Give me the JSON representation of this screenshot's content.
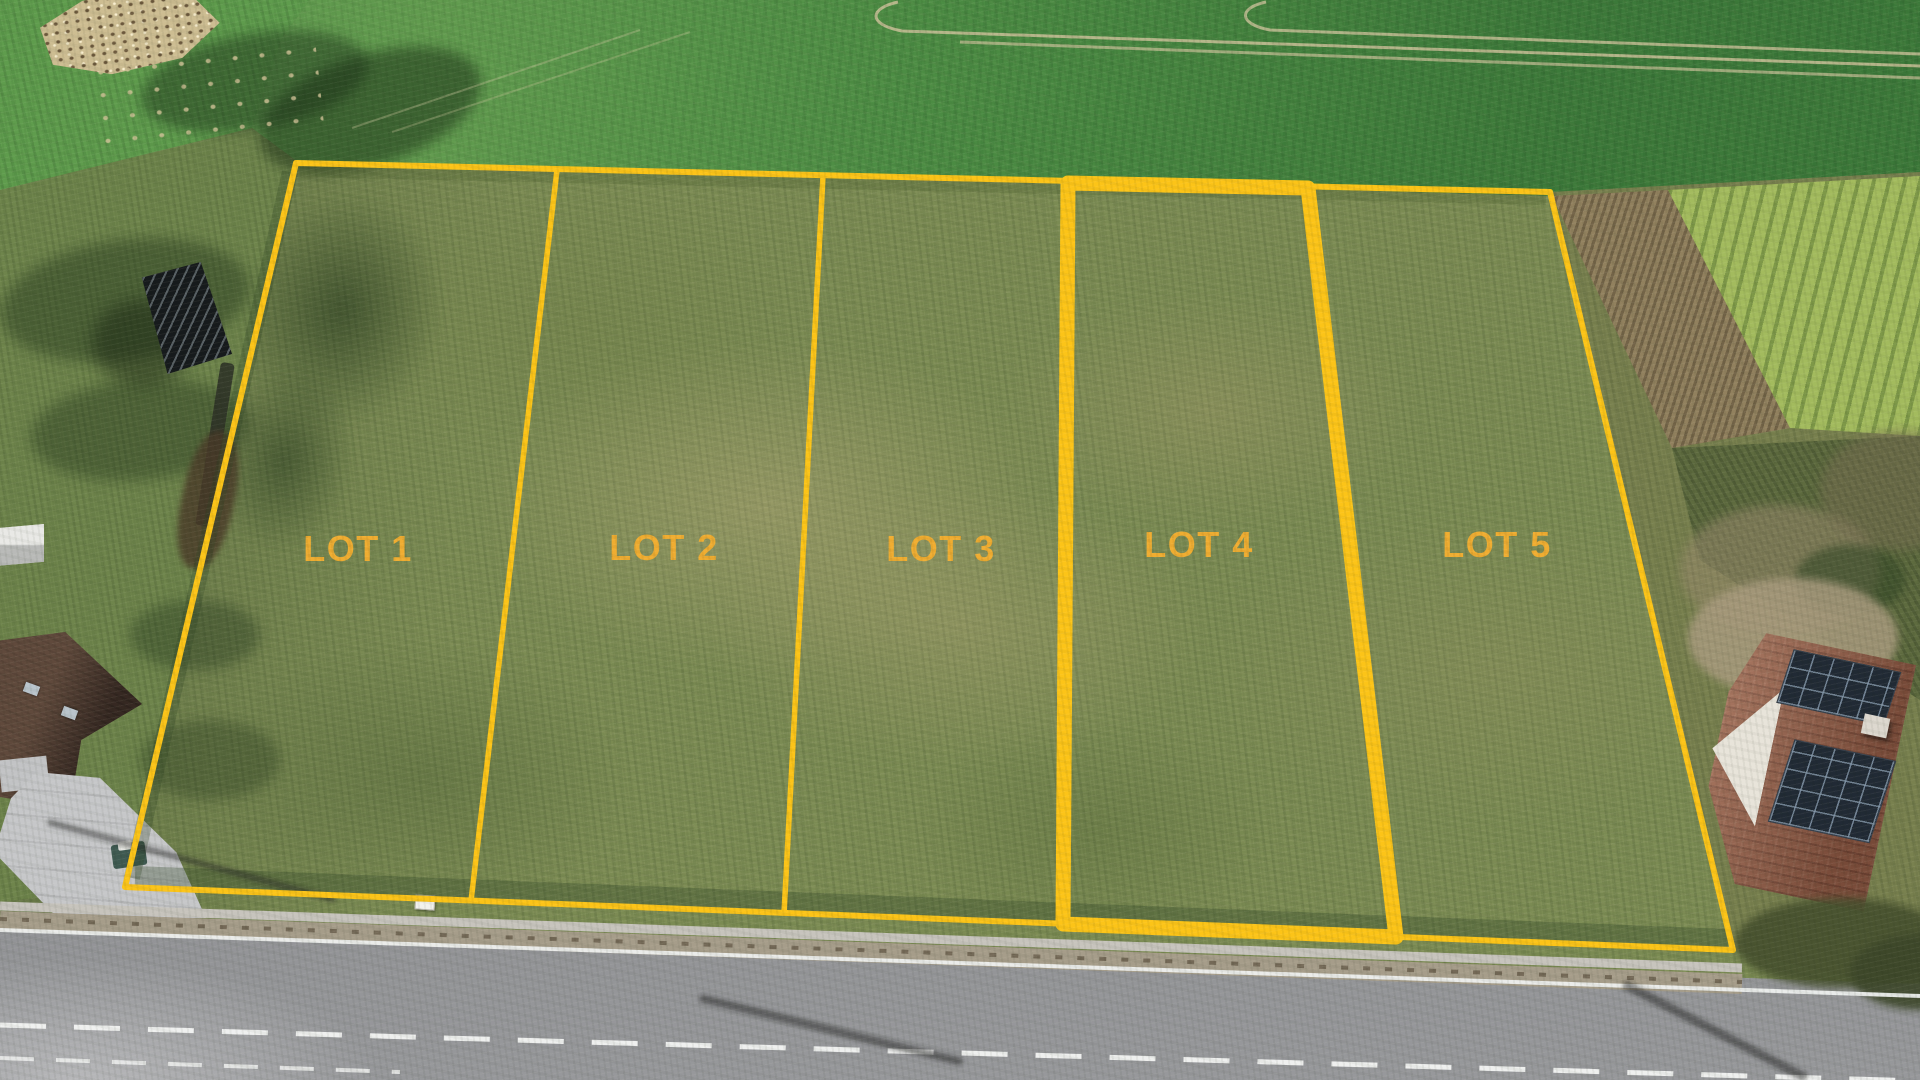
{
  "overlay": {
    "boundary_color": "#fcc418",
    "label_color": "#f0ad31",
    "lots": [
      {
        "id": "lot-1",
        "label": "LOT 1",
        "highlighted": false
      },
      {
        "id": "lot-2",
        "label": "LOT 2",
        "highlighted": false
      },
      {
        "id": "lot-3",
        "label": "LOT 3",
        "highlighted": false
      },
      {
        "id": "lot-4",
        "label": "LOT 4",
        "highlighted": true
      },
      {
        "id": "lot-5",
        "label": "LOT 5",
        "highlighted": false
      }
    ]
  }
}
